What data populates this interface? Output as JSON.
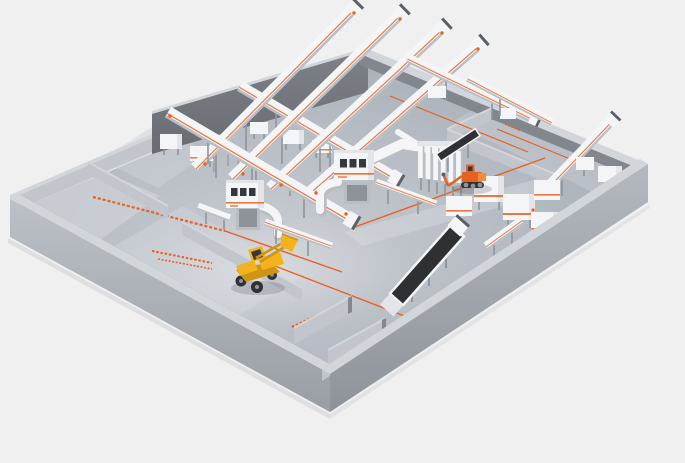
{
  "canvas": {
    "width": 685,
    "height": 463
  },
  "scene": {
    "type": "3d-isometric-render",
    "subject": "industrial waste recycling and sorting plant layout",
    "visible_text": "no legible text; only small orange floor lettering (illegible at this resolution)",
    "inventory": [
      "perimeter-walled floor platform",
      "tall dark back wall",
      "upper-left storage bays with partition walls",
      "bottom storage bays with partition walls",
      "four radial inclined conveyors extending over the back wall",
      "two crossing inclined conveyors",
      "short cross conveyors near top-right corner",
      "white air duct pipes with elbows",
      "two control cabin towers with three dark windows and orange stripe",
      "filter tank battery (six vertical cylinders)",
      "dark belt inclined conveyor (center bottom)",
      "right-side processing machine line (three machines plus connector conveyor)",
      "walled room at top right with inclined conveyor and machine boxes",
      "orange material handler with articulated boom",
      "yellow wheel loader with raised bucket",
      "orange painted aisle lines on floor",
      "orange floor text markings (illegible)"
    ]
  },
  "palette": {
    "bg": "#f0f0f1",
    "floorBase": "#aeb4bc",
    "floorLight": "#cdd1d7",
    "floorDark": "#969ca5",
    "aisle": "#d8dbdf",
    "wallTop": "#d2d5da",
    "wallOuterLight": "#c2c6cc",
    "wallOuter": "#b0b4bb",
    "wallOuterDark": "#94999f",
    "wallInner": "#82868d",
    "wallInnerDark": "#787c83",
    "backWall": "#72767d",
    "machineWhite": "#f4f5f7",
    "machineLight": "#e3e5e9",
    "machineGray": "#b9bdc4",
    "machineDark": "#5b5f66",
    "steel": "#8f949c",
    "belt": "#2e3033",
    "accent": "#e8611f",
    "accentSoft": "#f08a45",
    "yellow": "#f2b31f",
    "yellowDark": "#cf9413",
    "window": "#35383d",
    "shadow": "rgba(70,75,85,0.22)"
  }
}
